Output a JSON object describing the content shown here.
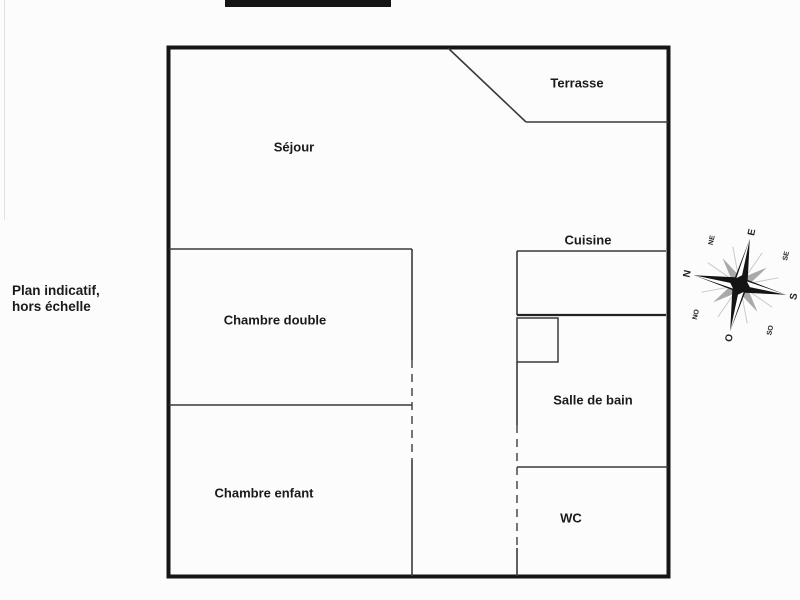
{
  "note": {
    "line1": "Plan indicatif,",
    "line2": "hors échelle"
  },
  "rooms": [
    {
      "name": "terrasse",
      "label": "Terrasse"
    },
    {
      "name": "sejour",
      "label": "Séjour"
    },
    {
      "name": "cuisine",
      "label": "Cuisine"
    },
    {
      "name": "chambre-double",
      "label": "Chambre double"
    },
    {
      "name": "salle-de-bain",
      "label": "Salle de bain"
    },
    {
      "name": "chambre-enfant",
      "label": "Chambre enfant"
    },
    {
      "name": "wc",
      "label": "WC"
    }
  ],
  "compass": {
    "cardinal": {
      "n": "N",
      "e": "E",
      "s": "S",
      "o": "O"
    },
    "intercardinal": {
      "ne": "NE",
      "se": "SE",
      "so": "SO",
      "no": "NO"
    },
    "rotation_deg": -78
  },
  "colors": {
    "background": "#fcfcfc",
    "wall": "#161616",
    "partition": "#3a3a3a",
    "text": "#1a1a1a",
    "redaction": "#151515",
    "compass_main": "#141414",
    "compass_secondary": "#a9a9a9"
  }
}
